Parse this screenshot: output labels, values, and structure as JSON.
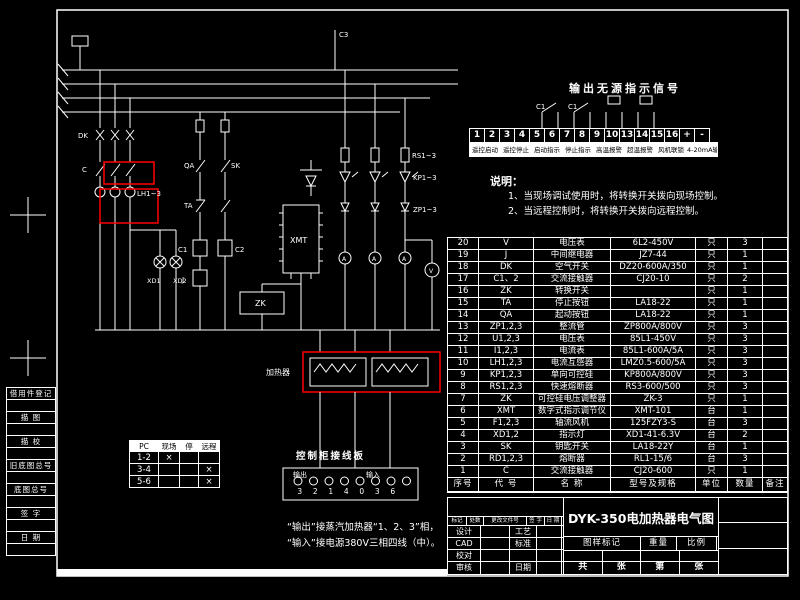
{
  "colors": {
    "background": "#000000",
    "line": "#ffffff",
    "highlight": "#ff0000"
  },
  "left_margin": {
    "labels": [
      "借用件登记",
      "描 图",
      "描 校",
      "旧底图总号",
      "底图总号",
      "签 字",
      "日 期"
    ]
  },
  "signal_table": {
    "title": "输出无源指示信号",
    "contact_labels": [
      "C1",
      "C1"
    ],
    "terminals": [
      "1",
      "2",
      "3",
      "4",
      "5",
      "6",
      "7",
      "8",
      "9",
      "10",
      "13",
      "14",
      "15",
      "16",
      "+",
      "-"
    ],
    "functions": [
      "遥控启动",
      "遥控停止",
      "启动指示",
      "停止指示",
      "高温报警",
      "超温报警",
      "风机联锁",
      "4-20mA输出"
    ]
  },
  "notes": {
    "heading": "说明：",
    "items": [
      "1、当现场调试使用时，将转换开关拨向现场控制。",
      "2、当远程控制时，将转换开关拨向远程控制。"
    ]
  },
  "bom": {
    "headers": [
      "序号",
      "代 号",
      "名  称",
      "型号及规格",
      "单位",
      "数量",
      "备注"
    ],
    "rows": [
      [
        "20",
        "V",
        "电压表",
        "6L2-450V",
        "只",
        "3",
        ""
      ],
      [
        "19",
        "J",
        "中间继电器",
        "JZ7-44",
        "只",
        "1",
        ""
      ],
      [
        "18",
        "DK",
        "空气开关",
        "DZ20-600A/350",
        "只",
        "1",
        ""
      ],
      [
        "17",
        "C1、2",
        "交流接触器",
        "CJ20-10",
        "只",
        "2",
        ""
      ],
      [
        "16",
        "ZK",
        "转换开关",
        "",
        "只",
        "1",
        ""
      ],
      [
        "15",
        "TA",
        "停止按钮",
        "LA18-22",
        "只",
        "1",
        ""
      ],
      [
        "14",
        "QA",
        "起动按钮",
        "LA18-22",
        "只",
        "1",
        ""
      ],
      [
        "13",
        "ZP1,2,3",
        "整流管",
        "ZP800A/800V",
        "只",
        "3",
        ""
      ],
      [
        "12",
        "U1,2,3",
        "电压表",
        "85L1-450V",
        "只",
        "3",
        ""
      ],
      [
        "11",
        "I1,2,3",
        "电流表",
        "85L1-600A/5A",
        "只",
        "3",
        ""
      ],
      [
        "10",
        "LH1,2,3",
        "电流互感器",
        "LMZ0.5-600/5A",
        "只",
        "3",
        ""
      ],
      [
        "9",
        "KP1,2,3",
        "单向可控硅",
        "KP800A/800V",
        "只",
        "3",
        ""
      ],
      [
        "8",
        "RS1,2,3",
        "快速熔断器",
        "RS3-600/500",
        "只",
        "3",
        ""
      ],
      [
        "7",
        "ZK",
        "可控硅电压调整器",
        "ZK-3",
        "只",
        "1",
        ""
      ],
      [
        "6",
        "XMT",
        "数字式指示调节仪",
        "XMT-101",
        "台",
        "1",
        ""
      ],
      [
        "5",
        "F1,2,3",
        "轴流风机",
        "125FZY3-S",
        "台",
        "3",
        ""
      ],
      [
        "4",
        "XD1,2",
        "指示灯",
        "XD1-41-6.3V",
        "台",
        "2",
        ""
      ],
      [
        "3",
        "SK",
        "钥匙开关",
        "LA18-22Y",
        "台",
        "1",
        ""
      ],
      [
        "2",
        "RD1,2,3",
        "熔断器",
        "RL1-15/6",
        "台",
        "3",
        ""
      ],
      [
        "1",
        "C",
        "交流接触器",
        "CJ20-600",
        "只",
        "1",
        ""
      ]
    ]
  },
  "title_block": {
    "drawing_title": "DYK-350电加热器电气图",
    "revision_strip": [
      "标记",
      "处数",
      "更改文件号",
      "签 字",
      "日 期"
    ],
    "left_labels": [
      "设计",
      "CAD",
      "校对",
      "审核"
    ],
    "right_labels": [
      "工艺",
      "标准",
      "",
      "日期"
    ],
    "mark_labels": [
      "图样标记",
      "重量",
      "比例"
    ],
    "sheet_labels": [
      "共",
      "张",
      "第",
      "张"
    ]
  },
  "pc_table": {
    "headers": [
      "PC",
      "现场",
      "停",
      "远程"
    ],
    "rows": [
      [
        "1-2",
        "×",
        "",
        ""
      ],
      [
        "3-4",
        "",
        "",
        "×"
      ],
      [
        "5-6",
        "",
        "",
        "×"
      ]
    ]
  },
  "terminal_board": {
    "title": "控制柜接线板",
    "group_labels": [
      "输出",
      "输入"
    ],
    "numbers": [
      "3",
      "2",
      "1",
      "4",
      "0",
      "3",
      "6"
    ]
  },
  "bottom_note": {
    "lines": [
      "“输出”接蒸汽加热器“1、2、3”相，",
      "“输入”接电源380V三相四线（中）。"
    ]
  },
  "circuit_labels": {
    "dk": "DK",
    "c": "C",
    "lh": "LH1~3",
    "rs": "RS1~3",
    "kp": "KP1~3",
    "zp": "ZP1~3",
    "qa": "QA",
    "ta": "TA",
    "sk": "SK",
    "c1": "C1",
    "c2": "C2",
    "j": "J",
    "xd1": "XD1",
    "xd2": "XD2",
    "xmt": "XMT",
    "zk": "ZK",
    "v": "V",
    "a": "A",
    "heater": "加热器",
    "c3": "C3"
  }
}
